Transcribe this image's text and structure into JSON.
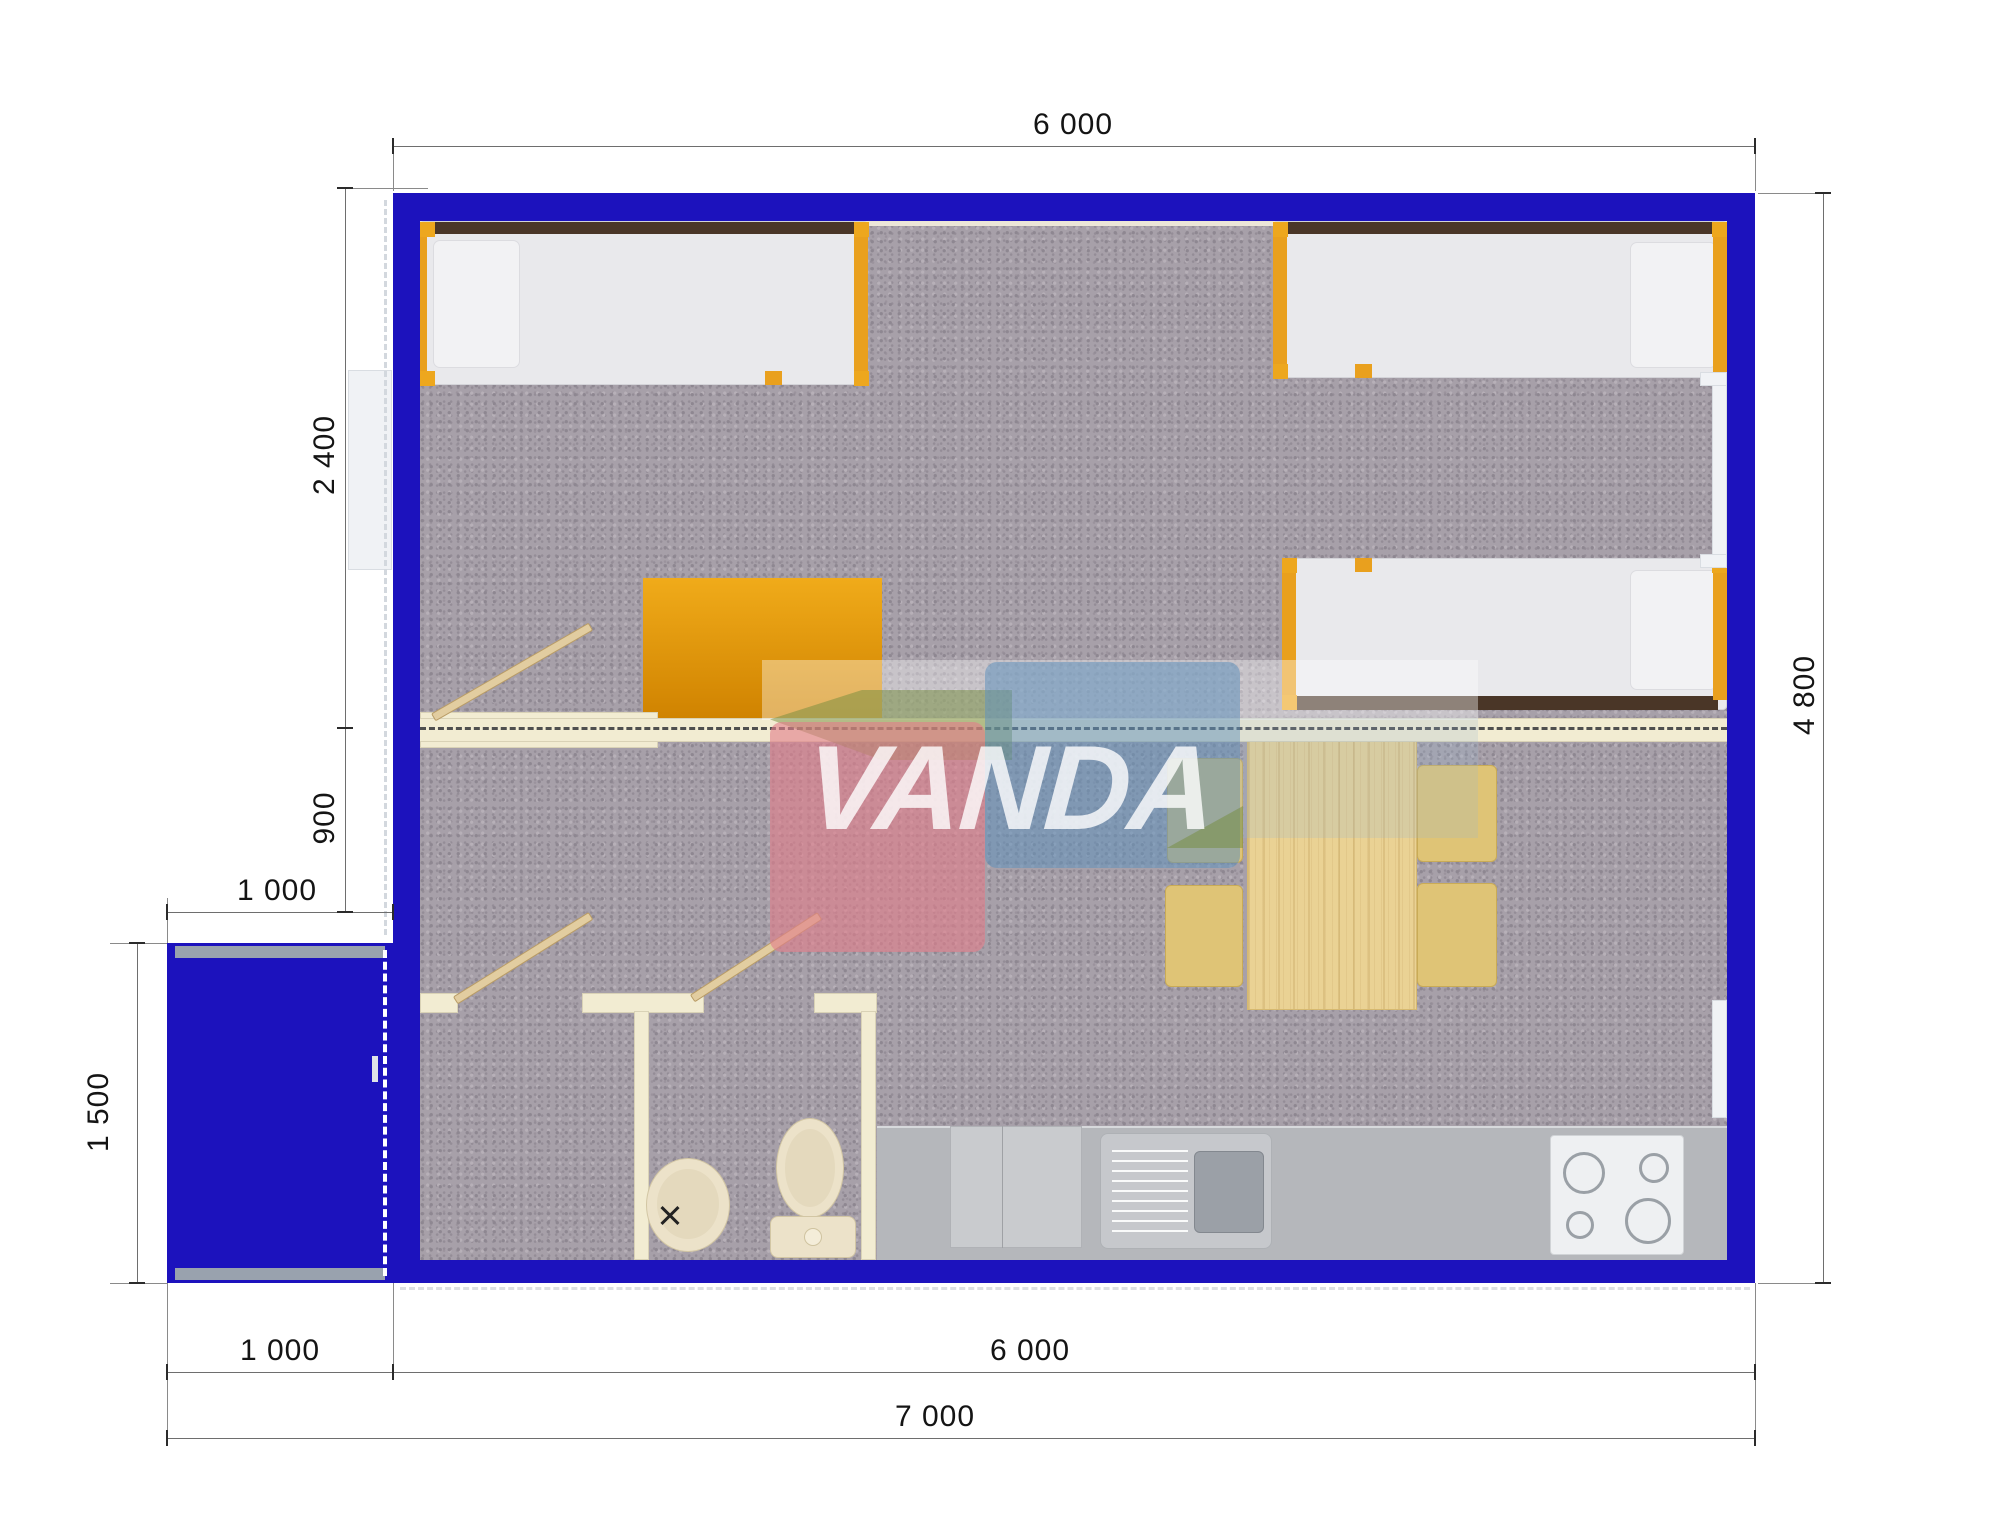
{
  "logo": {
    "text": "VANDA"
  },
  "dimensions": {
    "top_width": "6 000",
    "right_height": "4 800",
    "left_bedroom_depth": "2 400",
    "left_offset": "900",
    "porch_width": "1 000",
    "porch_depth": "1 500",
    "bottom_porch_width": "1 000",
    "bottom_main_width": "6 000",
    "bottom_total_width": "7 000"
  },
  "palette": {
    "wall_blue": "#1c12bd",
    "carpet_gray": "#a7a0a9",
    "interior_wall_cream": "#f2ecd2",
    "furniture_orange": "#e9a01e",
    "headboard_brown": "#4a3627",
    "pine_wood": "#ead294",
    "counter_gray": "#b5b7bb",
    "logo_pink": "#e27e8a",
    "logo_blue": "#6092bc",
    "logo_green": "#738c3c"
  },
  "objects": {
    "beds": 3,
    "desk": 1,
    "dining_table": 1,
    "chairs": 4,
    "wash_basin": 1,
    "toilet": 1,
    "kitchen_sink": 1,
    "stove_burners": 4,
    "porch": 1,
    "windows": 3,
    "door_leaves": 3
  }
}
